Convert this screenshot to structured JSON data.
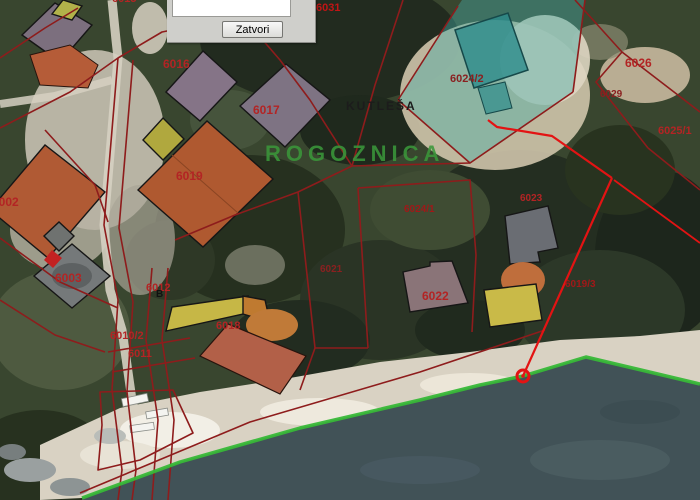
{
  "window": {
    "dialog": {
      "close_label": "Zatvori"
    }
  },
  "map": {
    "place_name": "ROGOZNICA",
    "hamlet_name": "KUTLEŠA",
    "colors": {
      "parcel_boundary": "#8e1c1c",
      "parcel_label": "#b32424",
      "measure_annotation": "#e31313",
      "coastline": "#38b838",
      "selection_overlay": "#49a8a0",
      "water": "#415257",
      "beach": "#d9d2c3"
    },
    "labels": [
      {
        "name": "parcel-label-6031",
        "text": "6031",
        "x": 316,
        "y": 3,
        "size": 11,
        "color": "#c21515"
      },
      {
        "name": "parcel-label-6015",
        "text": "6015",
        "x": 112,
        "y": -6,
        "size": 11,
        "color": "#b32424"
      },
      {
        "name": "parcel-label-6016",
        "text": "6016",
        "x": 163,
        "y": 58,
        "size": 12,
        "color": "#b32424"
      },
      {
        "name": "parcel-label-6017",
        "text": "6017",
        "x": 253,
        "y": 104,
        "size": 12,
        "color": "#b32424"
      },
      {
        "name": "parcel-label-6019",
        "text": "6019",
        "x": 176,
        "y": 170,
        "size": 12,
        "color": "#b32424"
      },
      {
        "name": "parcel-label-6002",
        "text": "6002",
        "x": -8,
        "y": 196,
        "size": 12,
        "color": "#b32424"
      },
      {
        "name": "parcel-label-6003",
        "text": "6003",
        "x": 55,
        "y": 272,
        "size": 12,
        "color": "#b32424"
      },
      {
        "name": "parcel-label-6012",
        "text": "6012",
        "x": 146,
        "y": 283,
        "size": 11,
        "color": "#b32424"
      },
      {
        "name": "parcel-label-6010-2",
        "text": "6010/2",
        "x": 110,
        "y": 331,
        "size": 11,
        "color": "#b32424"
      },
      {
        "name": "parcel-label-6011",
        "text": "6011",
        "x": 128,
        "y": 349,
        "size": 11,
        "color": "#b32424"
      },
      {
        "name": "parcel-label-6018",
        "text": "6018",
        "x": 216,
        "y": 321,
        "size": 11,
        "color": "#b32424"
      },
      {
        "name": "parcel-label-6021",
        "text": "6021",
        "x": 320,
        "y": 265,
        "size": 10,
        "color": "#8a2020"
      },
      {
        "name": "parcel-label-6022",
        "text": "6022",
        "x": 422,
        "y": 290,
        "size": 12,
        "color": "#b32424"
      },
      {
        "name": "parcel-label-6023",
        "text": "6023",
        "x": 520,
        "y": 194,
        "size": 10,
        "color": "#b32424"
      },
      {
        "name": "parcel-label-6024-2",
        "text": "6024/2",
        "x": 450,
        "y": 74,
        "size": 11,
        "color": "#8a2020"
      },
      {
        "name": "parcel-label-6024-1",
        "text": "6024/1",
        "x": 404,
        "y": 205,
        "size": 10,
        "color": "#a01818"
      },
      {
        "name": "parcel-label-6019-3",
        "text": "6019/3",
        "x": 565,
        "y": 280,
        "size": 10,
        "color": "#a01818"
      },
      {
        "name": "parcel-label-6026",
        "text": "6026",
        "x": 625,
        "y": 57,
        "size": 12,
        "color": "#b32424"
      },
      {
        "name": "parcel-label-6029",
        "text": "6029",
        "x": 600,
        "y": 90,
        "size": 10,
        "color": "#8a2020"
      },
      {
        "name": "parcel-label-6025-1",
        "text": "6025/1",
        "x": 658,
        "y": 126,
        "size": 11,
        "color": "#b32424"
      },
      {
        "name": "place-label-rogoznica",
        "text": "ROGOZNICA",
        "x": 265,
        "y": 143,
        "size": 22,
        "ls": 5,
        "color": "rgba(58,150,58,0.88)"
      },
      {
        "name": "place-label-kutlesa",
        "text": "KUTLEŠA",
        "x": 346,
        "y": 100,
        "size": 12,
        "ls": 2,
        "color": "#1c1c1c"
      },
      {
        "name": "map-annotation-b",
        "text": "B",
        "x": 156,
        "y": 290,
        "size": 10,
        "color": "#111111"
      }
    ]
  }
}
